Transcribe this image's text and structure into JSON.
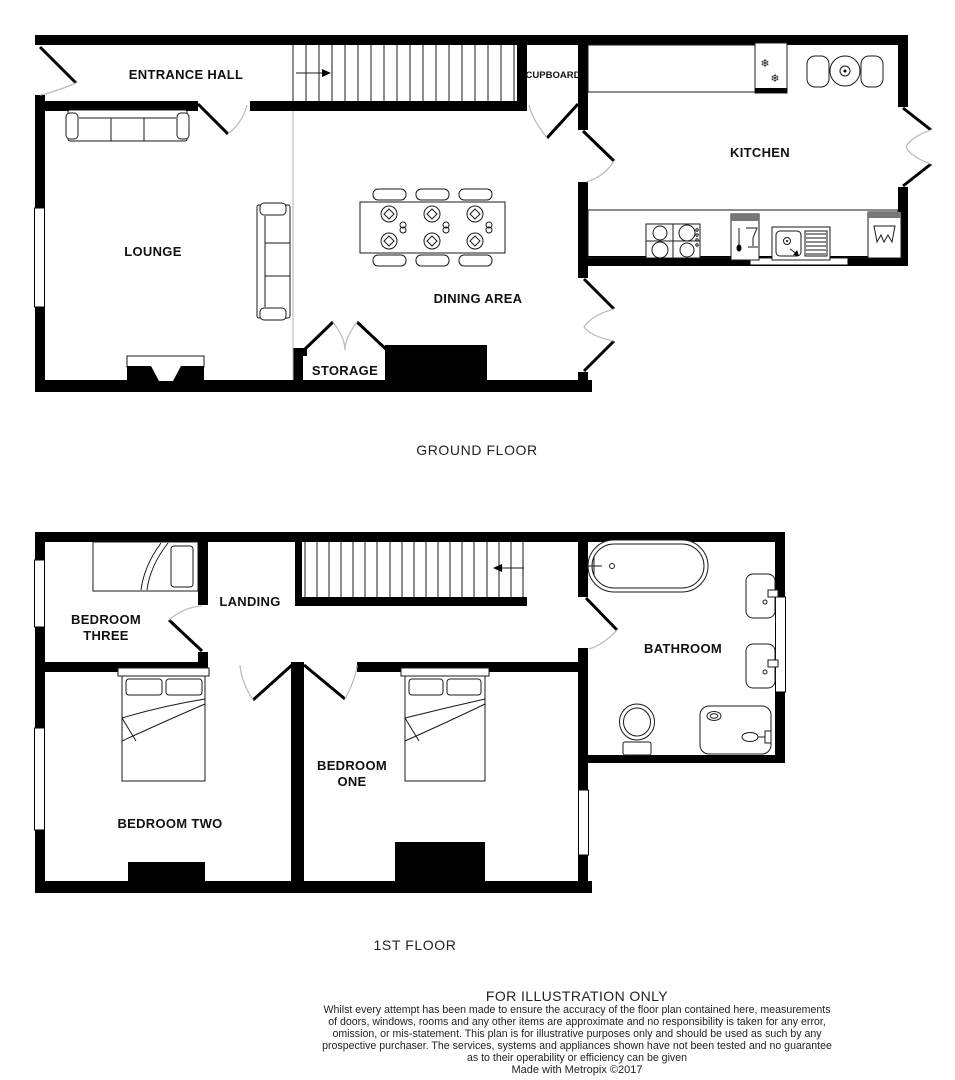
{
  "colors": {
    "wall": "#000000",
    "background": "#ffffff",
    "furniture_line": "#1a1a1a",
    "door_arc": "#bdbdbd",
    "open_plan_divider": "#b0b0b0"
  },
  "icons": {
    "snowflake": "❄"
  },
  "ground_floor": {
    "title": "GROUND FLOOR",
    "rooms": {
      "entrance_hall": "ENTRANCE HALL",
      "cupboard": "CUPBOARD",
      "kitchen": "KITCHEN",
      "lounge": "LOUNGE",
      "dining_area": "DINING AREA",
      "storage": "STORAGE"
    }
  },
  "first_floor": {
    "title": "1ST FLOOR",
    "rooms": {
      "landing": "LANDING",
      "bedroom_three": [
        "BEDROOM",
        "THREE"
      ],
      "bathroom": "BATHROOM",
      "bedroom_two": "BEDROOM TWO",
      "bedroom_one": [
        "BEDROOM",
        "ONE"
      ]
    }
  },
  "footer": {
    "title": "FOR ILLUSTRATION ONLY",
    "disclaimer_lines": [
      "Whilst every attempt has been made to ensure the accuracy of the floor plan contained here, measurements",
      "of doors, windows, rooms and any other items are approximate and no responsibility is taken for any error,",
      "omission, or mis-statement. This plan is for illustrative purposes only and should be used as such by any",
      "prospective purchaser. The services, systems and appliances shown have not been tested and no guarantee",
      "as to their operability or efficiency can be given"
    ],
    "credit": "Made with Metropix ©2017"
  }
}
